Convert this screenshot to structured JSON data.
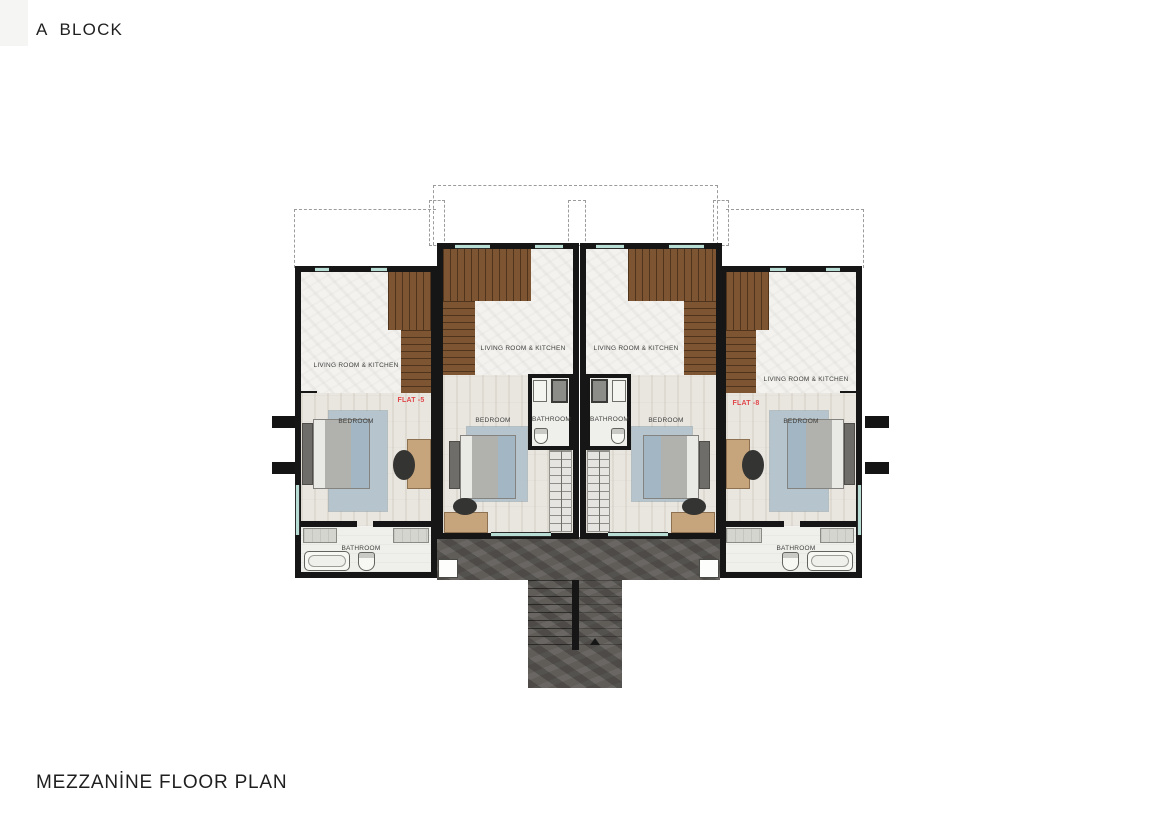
{
  "title": "A  BLOCK",
  "caption": "MEZZANİNE FLOOR PLAN",
  "flats": [
    {
      "label": "FLAT -5",
      "living": "LIVING ROOM & KITCHEN",
      "bedroom": "BEDROOM",
      "bathroom": "BATHROOM"
    },
    {
      "label": "FLAT -6",
      "living": "LIVING ROOM & KITCHEN",
      "bedroom": "BEDROOM",
      "bathroom": "BATHROOM"
    },
    {
      "label": "FLAT -7",
      "living": "LIVING ROOM & KITCHEN",
      "bedroom": "BEDROOM",
      "bathroom": "BATHROOM"
    },
    {
      "label": "FLAT -8",
      "living": "LIVING ROOM & KITCHEN",
      "bedroom": "BEDROOM",
      "bathroom": "BATHROOM"
    }
  ],
  "colors": {
    "wall": "#161616",
    "flat_label_accent": "#e0474a",
    "stair_wood": "#7d5533",
    "stone_terrace": "#605d59",
    "window_glass": "#b7ddd5",
    "living_floor": "#f3f2ef",
    "bedroom_floor": "#e9e6e0",
    "rug": "#b6c4cd",
    "desk": "#c7a57c"
  }
}
